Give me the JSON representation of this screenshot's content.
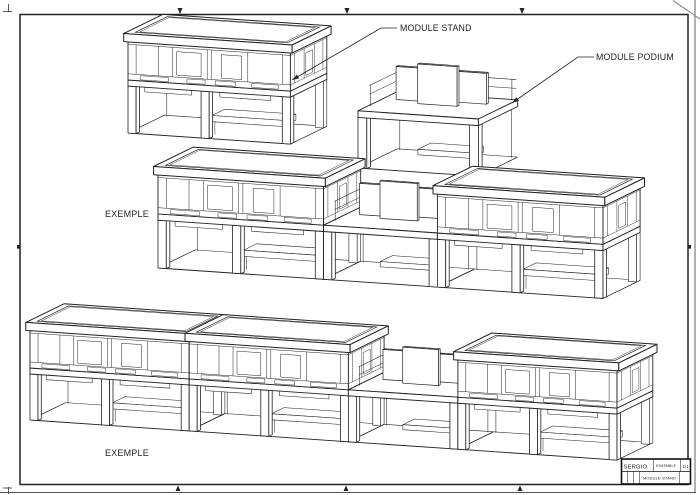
{
  "sheet": {
    "background": "#ffffff",
    "line_color": "#222222"
  },
  "labels": {
    "module_stand": "MODULE STAND",
    "module_podium": "MODULE PODIUM",
    "exemple_1": "EXEMPLE",
    "exemple_2": "EXEMPLE"
  },
  "title_block": {
    "project": "SERGIO",
    "detail": "ENSEMBLE",
    "scale": "1/1",
    "title": "MODULE STAND"
  },
  "assemblies": {
    "module_stand": [
      "stand"
    ],
    "module_podium": [
      "podium"
    ],
    "exemple_1": [
      "stand",
      "podium",
      "stand"
    ],
    "exemple_2": [
      "stand",
      "stand",
      "podium",
      "stand"
    ]
  }
}
